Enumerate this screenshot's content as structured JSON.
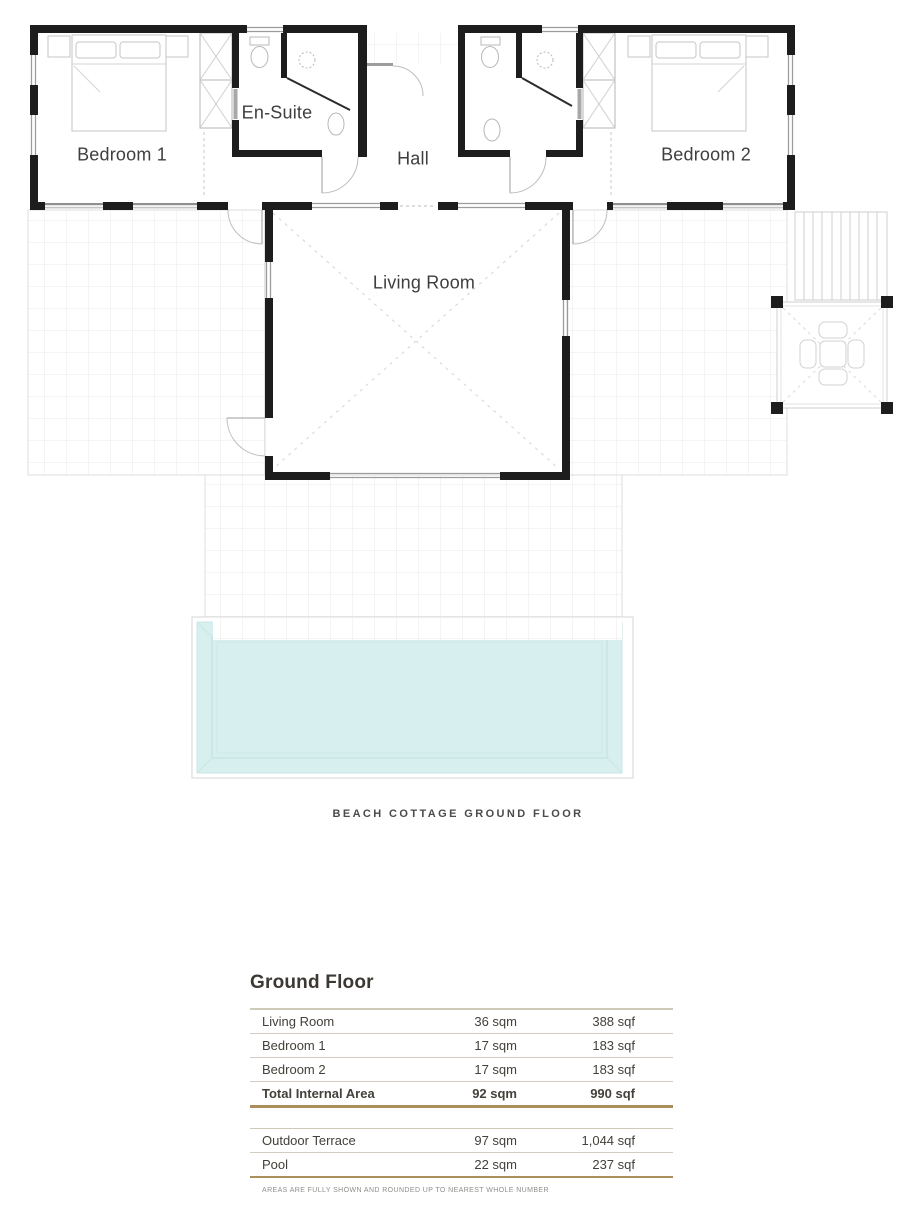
{
  "plan": {
    "rooms": {
      "bedroom1": "Bedroom 1",
      "ensuite": "En-Suite",
      "hall": "Hall",
      "bedroom2": "Bedroom 2",
      "living_room": "Living Room"
    },
    "caption": "BEACH COTTAGE GROUND FLOOR",
    "colors": {
      "wall": "#1d1d1d",
      "terrace_grid": "#e9e9e9",
      "pool_water": "#d7efee",
      "pool_rim": "#bfe2e0",
      "furniture_outline": "#c6c6c6"
    }
  },
  "area_table": {
    "title": "Ground Floor",
    "internal_rows": [
      {
        "name": "Living Room",
        "sqm": "36 sqm",
        "sqf": "388 sqf"
      },
      {
        "name": "Bedroom 1",
        "sqm": "17 sqm",
        "sqf": "183 sqf"
      },
      {
        "name": "Bedroom 2",
        "sqm": "17 sqm",
        "sqf": "183 sqf"
      }
    ],
    "total_row": {
      "name": "Total Internal Area",
      "sqm": "92 sqm",
      "sqf": "990 sqf"
    },
    "outdoor_rows": [
      {
        "name": "Outdoor Terrace",
        "sqm": "97 sqm",
        "sqf": "1,044 sqf"
      },
      {
        "name": "Pool",
        "sqm": "22 sqm",
        "sqf": "237 sqf"
      }
    ],
    "footnote": "AREAS ARE FULLY SHOWN AND ROUNDED UP TO NEAREST WHOLE NUMBER",
    "accent_color": "#aa8e5c"
  }
}
